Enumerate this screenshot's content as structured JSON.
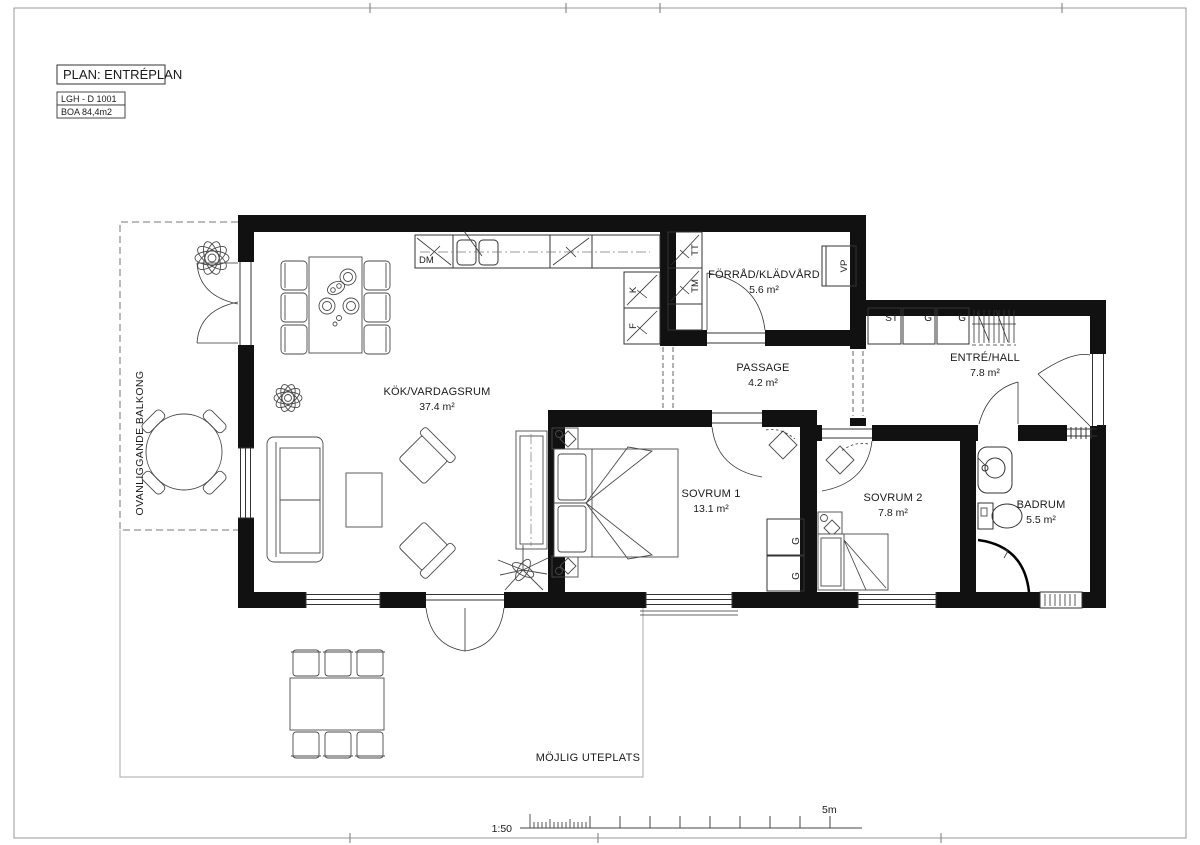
{
  "sheet": {
    "plan_title": "PLAN: ENTRÉPLAN",
    "apartment_id": "LGH - D 1001",
    "boa": "BOA 84,4m2",
    "scale_ratio": "1:50",
    "scale_length": "5m"
  },
  "rooms": {
    "kitchen_living": {
      "name": "KÖK/VARDAGSRUM",
      "area": "37.4 m²"
    },
    "storage": {
      "name": "FÖRRÅD/KLÄDVÅRD",
      "area": "5.6 m²"
    },
    "passage": {
      "name": "PASSAGE",
      "area": "4.2 m²"
    },
    "hall": {
      "name": "ENTRÉ/HALL",
      "area": "7.8 m²"
    },
    "bedroom1": {
      "name": "SOVRUM 1",
      "area": "13.1 m²"
    },
    "bedroom2": {
      "name": "SOVRUM 2",
      "area": "7.8 m²"
    },
    "bathroom": {
      "name": "BADRUM",
      "area": "5.5 m²"
    }
  },
  "outdoor": {
    "balcony": "OVANLIGGANDE BALKONG",
    "terrace": "MÖJLIG UTEPLATS"
  },
  "appliances": {
    "dishwasher": "DM",
    "fridge": "K",
    "freezer": "F",
    "dryer": "TT",
    "washer": "TM",
    "heatpump": "VP",
    "cleaning_cab": "ST",
    "wardrobe_hall_1": "G",
    "wardrobe_hall_2": "G",
    "wardrobe_bed1_a": "G",
    "wardrobe_bed1_b": "G"
  },
  "colors": {
    "wall": "#111111",
    "line": "#333333",
    "furniture": "#4a4a4a",
    "border": "#999999"
  }
}
